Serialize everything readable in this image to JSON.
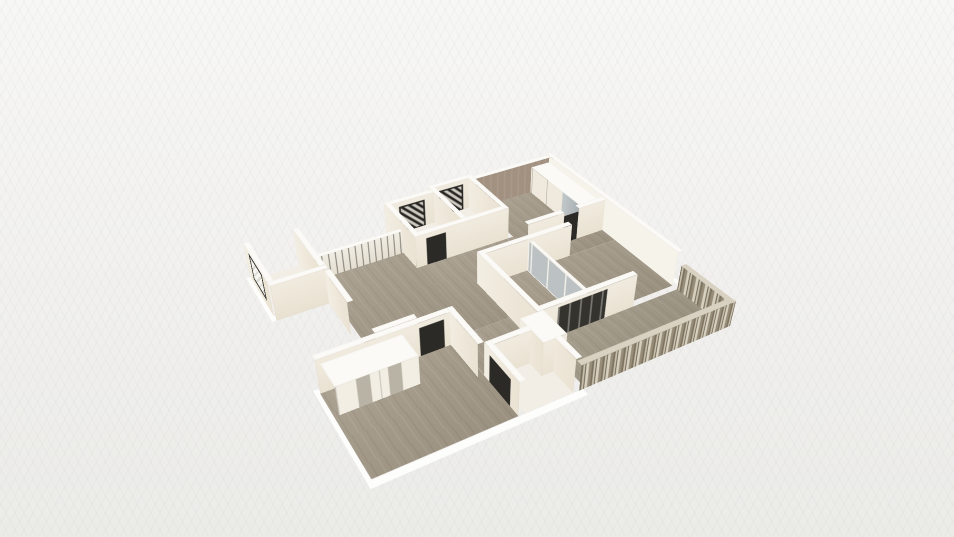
{
  "app": {
    "name": "3D floor plan viewport",
    "description": "Aerial oblique render of an apartment floor plan with cream walls, wood flooring, windows, wardrobes and a slatted balcony railing on a pale textured background"
  },
  "colors": {
    "bg-top": "#f7f7f5",
    "bg-bottom": "#ebebe8",
    "wall-top": "#fbfaf6",
    "wall-face": "#f1ebdf",
    "wall-shade": "#eae2d2",
    "wall-bright": "#f6f3ea",
    "wood": "#a49a89",
    "floor-light": "#f2eee6",
    "accent": "#a29180",
    "frame": "#2b2a26",
    "glass": "#bcc2c4"
  },
  "scene": {
    "type": "3d-floor-plan-render",
    "view": "aerial-oblique",
    "elements": [
      "entry-room-with-window",
      "hallway-with-glass-balustrade",
      "bathroom-top-a",
      "bathroom-top-b",
      "bedroom-top-right-with-wardrobe-and-accent-wall",
      "bedroom-right-with-glass-partition",
      "bedroom-left-with-cabinets",
      "small-bathroom",
      "balcony-with-slat-railing",
      "wood-flooring",
      "white-walls"
    ]
  }
}
